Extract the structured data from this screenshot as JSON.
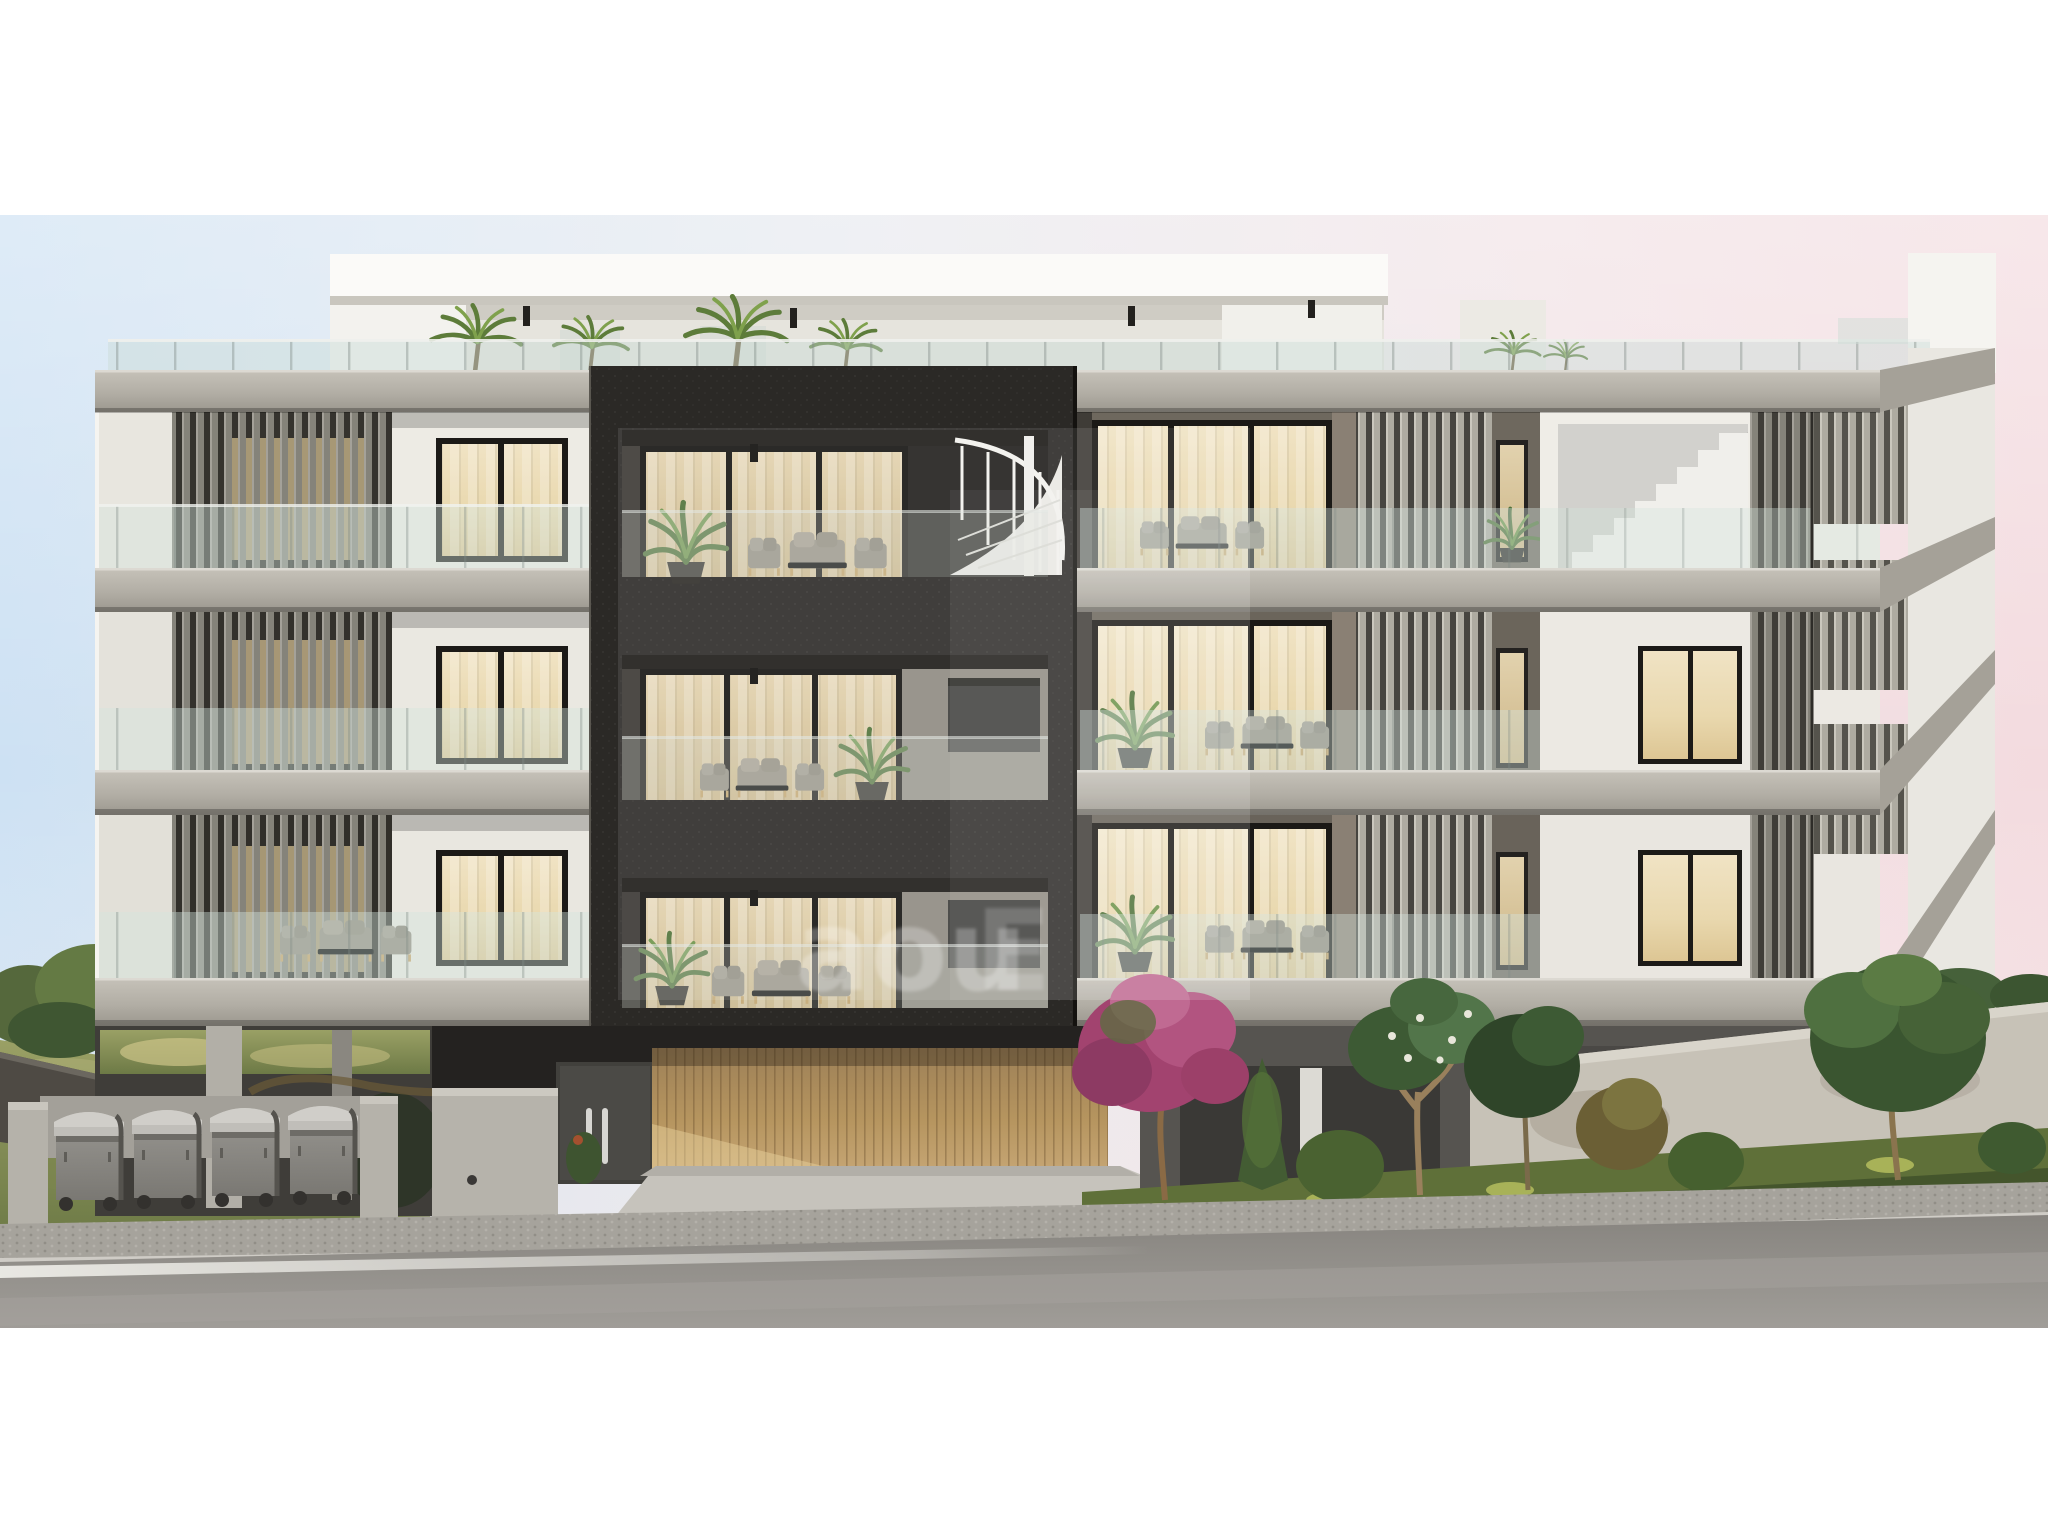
{
  "scene": {
    "kind": "architectural_render",
    "subject": "Modern 3-storey apartment building street elevation at dusk, warm lit interiors",
    "floors": 3,
    "trash_bins": 4
  },
  "watermark": {
    "text": "aou",
    "partial_letter": "E"
  },
  "palette": {
    "white_frame": "#ffffff",
    "sky_left": "#cfe2f3",
    "sky_mid": "#e9e9ee",
    "sky_right": "#f4dfe3",
    "concrete_light": "#b9b5ac",
    "concrete_shadow": "#8f8c84",
    "facade_white": "#edebe4",
    "louver_gray": "#8a887f",
    "louver_light": "#b2afa5",
    "dark_volume": "#2b2926",
    "window_warm": "#e9dab4",
    "window_frame": "#1a1815",
    "wood_slat": "#c2a475",
    "glass_tint": "#cfe0da",
    "road_asphalt": "#908d8a",
    "pavement": "#a7a49d",
    "lane_line": "#f2f1ec",
    "grass_green": "#5f7039",
    "bush_green": "#44602f",
    "bougainvillea": "#b25480",
    "bin_gray": "#8b8984",
    "field_green": "#8a9159",
    "watermark_color": "#ffffff"
  }
}
